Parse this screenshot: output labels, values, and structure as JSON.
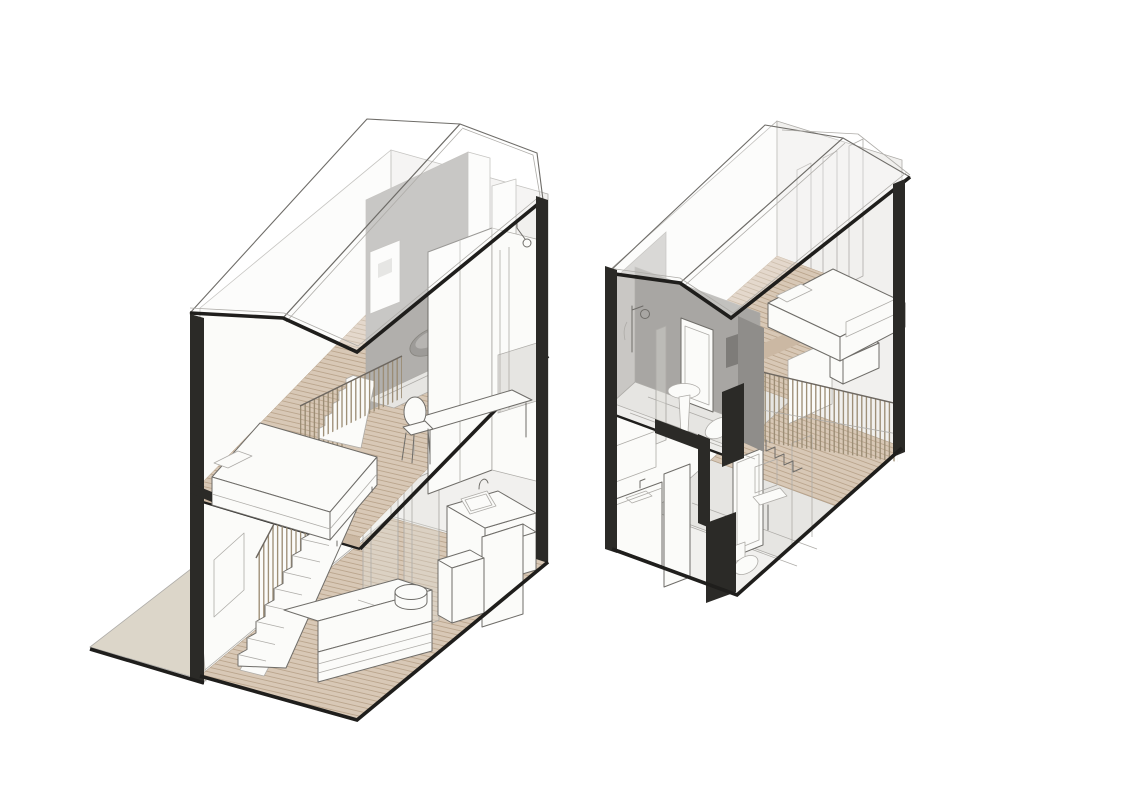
{
  "palette": {
    "background": "#ffffff",
    "line": "#6f6d69",
    "line_light": "#aeaca8",
    "line_dark": "#1f1e1c",
    "poche_dark": "#2b2a27",
    "wall_white": "#fbfbf9",
    "wall_shaded": "#f1f0ee",
    "wall_gray": "#b1afac",
    "wall_gray_light": "#c9c7c4",
    "partition_gray": "#a8a6a3",
    "wood_floor": "#d8c8b6",
    "wood_plank_line": "#b7a188",
    "wood_edge": "#cbb8a3",
    "terrace": "#dcd6c9",
    "tile_floor": "#e6e5e2",
    "fixture_gray": "#9d9b98",
    "slat_wood": "#9a8b73",
    "glass": "#e1e1de"
  },
  "scene": {
    "drawing_type": "axonometric-cutaway-section",
    "units": [
      {
        "id": "left-unit",
        "components": [
          "gable-roof-wireframe",
          "terrace-slab",
          "two-storey-cut-walls",
          "timber-deck-floors",
          "straight-staircase",
          "slat-balustrade",
          "sofa",
          "round-side-table",
          "kitchen-counter",
          "kitchen-sink",
          "faucet",
          "tall-cabinets",
          "double-bed",
          "pillow",
          "desk",
          "chair",
          "wc-room",
          "wall-hung-toilet",
          "cistern-panel",
          "wardrobe",
          "shower-head",
          "glass-screen",
          "picture-frame",
          "structural-columns"
        ]
      },
      {
        "id": "right-unit",
        "components": [
          "gable-roof-wireframe",
          "upper-bathroom",
          "shower-set",
          "glass-screen",
          "pedestal-sink",
          "wall-hung-toilet",
          "bathroom-door",
          "towel",
          "double-bed",
          "duvet",
          "pillow",
          "bed-platform",
          "step-box",
          "slat-balustrade",
          "staircase",
          "timber-deck-floors",
          "tile-floors",
          "kitchen-counter",
          "wall-cabinet",
          "ground-bathroom",
          "washbasin",
          "toilet",
          "mirror",
          "door-frames",
          "window-frames",
          "structural-columns"
        ]
      }
    ]
  }
}
